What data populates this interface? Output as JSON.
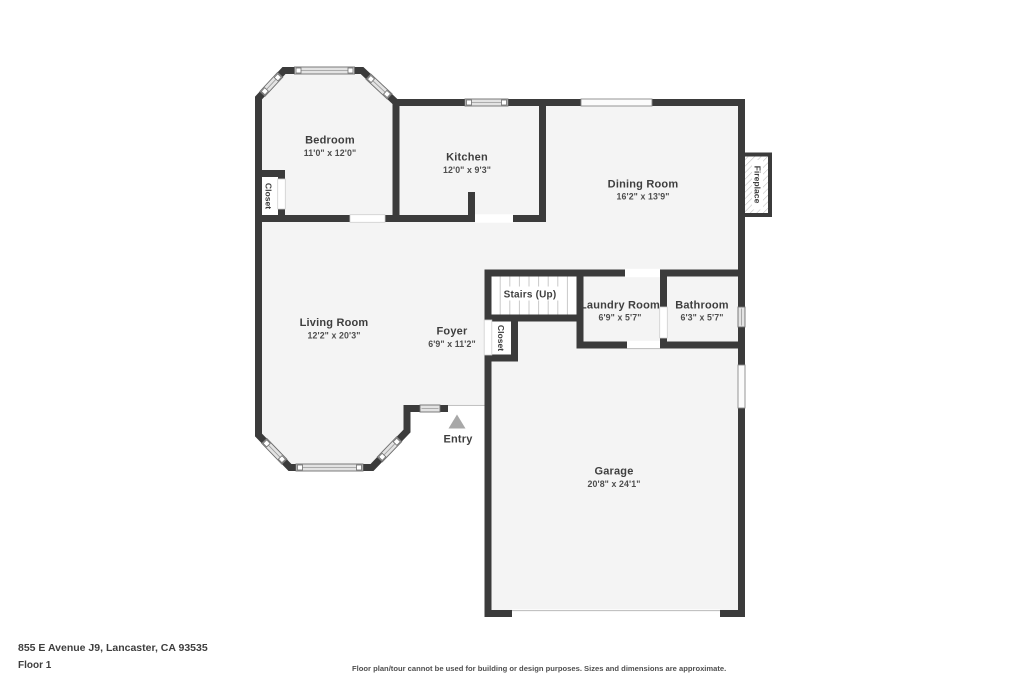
{
  "page": {
    "address": "855 E Avenue J9, Lancaster, CA 93535",
    "floor_label": "Floor 1",
    "disclaimer": "Floor plan/tour cannot be used for building or design purposes. Sizes and dimensions are approximate."
  },
  "rooms": {
    "bedroom": {
      "name": "Bedroom",
      "dims": "11'0\" x 12'0\""
    },
    "kitchen": {
      "name": "Kitchen",
      "dims": "12'0\" x 9'3\""
    },
    "dining_room": {
      "name": "Dining Room",
      "dims": "16'2\" x 13'9\""
    },
    "living_room": {
      "name": "Living Room",
      "dims": "12'2\" x 20'3\""
    },
    "foyer": {
      "name": "Foyer",
      "dims": "6'9\" x 11'2\""
    },
    "stairs": {
      "name": "Stairs (Up)"
    },
    "laundry_room": {
      "name": "Laundry Room",
      "dims": "6'9\" x 5'7\""
    },
    "bathroom": {
      "name": "Bathroom",
      "dims": "6'3\" x 5'7\""
    },
    "garage": {
      "name": "Garage",
      "dims": "20'8\" x 24'1\""
    },
    "entry": {
      "name": "Entry"
    },
    "bedroom_closet": {
      "name": "Closet"
    },
    "foyer_closet": {
      "name": "Closet"
    },
    "fireplace": {
      "name": "Fireplace"
    }
  },
  "colors": {
    "wall": "#3b3b3b",
    "floor": "#f4f4f4",
    "window": "#e3e3e3"
  }
}
